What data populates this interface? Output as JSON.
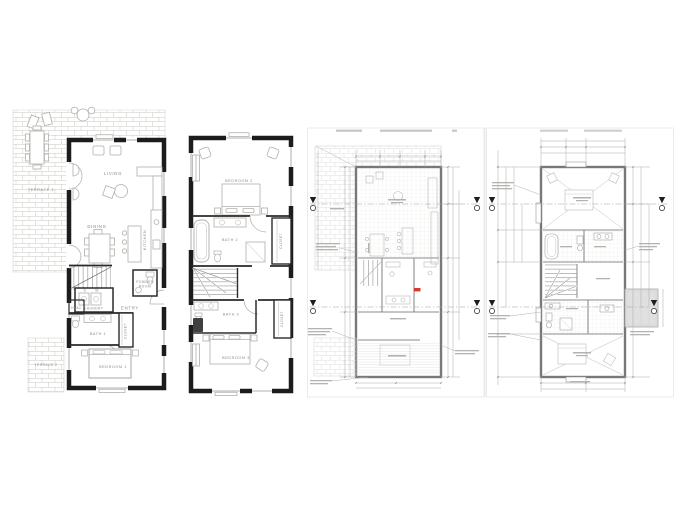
{
  "colors": {
    "wall_black": "#1c1c1c",
    "label_gray": "#8d8a86",
    "sketch_line": "#b3afab",
    "brick_line": "#cfccc7",
    "cad_line": "#9f9f9f",
    "cad_wall": "#757575",
    "accent_red": "#d63a2e",
    "dormer_fill": "#e0e0e0"
  },
  "sheet1": {
    "labels": {
      "terrace1": "TERRACE 1",
      "living": "LIVING",
      "dining": "DINING",
      "kitchen": "KITCHEN",
      "d": "D",
      "w": "W",
      "laundry": "LAUNDRY",
      "hvac": "HVAC",
      "entry": "ENTRY",
      "powder1": "POWDER",
      "powder2": "ROOM",
      "bath1": "BATH 1",
      "closet": "CLOSET",
      "bedroom1": "BEDROOM 1",
      "terrace2": "TERRACE 2"
    }
  },
  "sheet2": {
    "labels": {
      "bedroom2": "BEDROOM 2",
      "bath2": "BATH 2",
      "closet_upper": "CLOSET",
      "bath3": "BATH 3",
      "closet_lower": "CLOSET",
      "bedroom3": "BEDROOM 3"
    }
  }
}
